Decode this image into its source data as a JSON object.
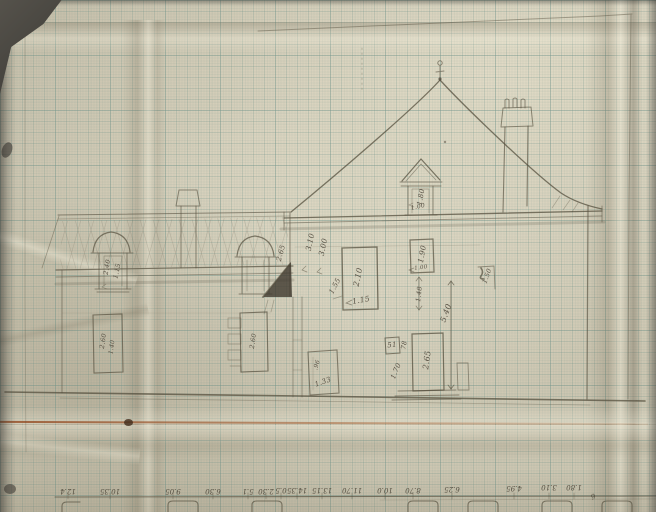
{
  "colors": {
    "paper": "#cdc6b1",
    "grid_line": "#649084",
    "pencil": "#56503f",
    "dark_pencil": "#3e382e",
    "crease": "#a05c32",
    "backdrop": "#3c3a36"
  },
  "dims": {
    "dormerL_h": "2.40",
    "dormerL_w": "1.15",
    "dormerC_h": "2.65",
    "wall_upper": "3.10",
    "wall_lower": "3.00",
    "dormerR_h": "1.80",
    "dormerR_w": "1.00",
    "winA_h": "2.10",
    "winA_w": "1.15",
    "winA_d": "1.55",
    "winB_h": "1.90",
    "winB_w": "1.00",
    "winB_below": "1.48",
    "markR": "1.50",
    "total_h": "5.40",
    "box": "51",
    "box_w": "78",
    "door_h": "2.65",
    "door_off": "1.70",
    "winC_h": ".96",
    "winC_w": "1.33",
    "winL_a": "2.60",
    "winL_b": "1.40",
    "winQ": "2.60"
  },
  "scale": [
    "12.4",
    "10.35",
    "9.05",
    "6.30",
    "5.1",
    "2.30",
    "0.5",
    "14.35",
    "13.15",
    "11.70",
    "10.0",
    "8.70",
    "6.25",
    "4.95",
    "3.10",
    "1.80",
    "6"
  ]
}
